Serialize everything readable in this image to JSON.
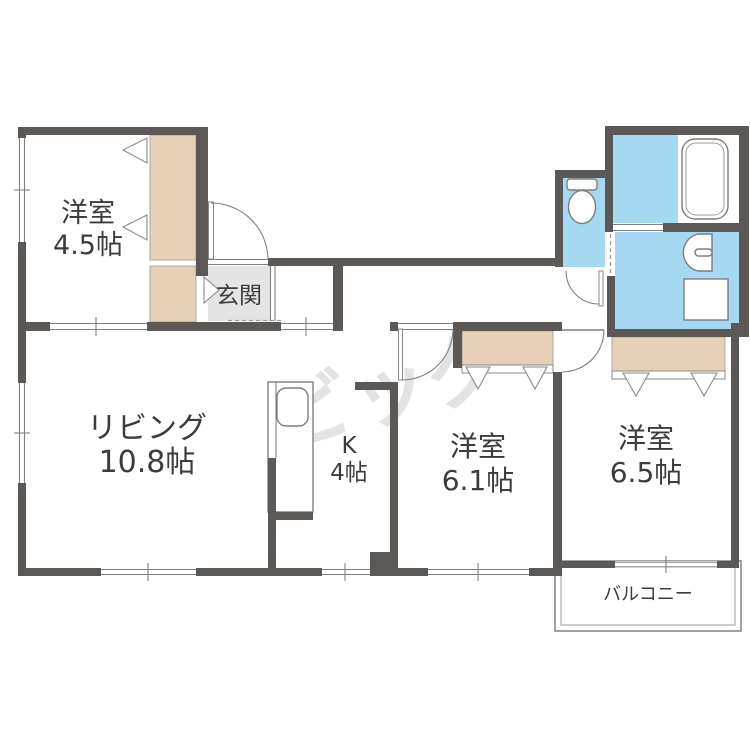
{
  "plan": {
    "title": "apartment-floor-plan",
    "rooms": [
      {
        "name": "洋室",
        "size": "4.5帖"
      },
      {
        "name": "リビング",
        "size": "10.8帖"
      },
      {
        "name": "K",
        "size": "4帖"
      },
      {
        "name": "洋室",
        "size": "6.1帖"
      },
      {
        "name": "洋室",
        "size": "6.5帖"
      }
    ],
    "entrance_label": "玄関",
    "balcony_label": "バルコニー",
    "watermark": "ビッグ",
    "fixtures": [
      "toilet",
      "bathtub",
      "washbasin",
      "washer-pan",
      "kitchen-counter-sink"
    ],
    "colors": {
      "wall": "#5b5856",
      "closet": "#e6d0b6",
      "water": "#a5d9f2",
      "genkan": "#e4e4e4",
      "line": "#808080",
      "text": "#3c3c3c",
      "watermark": "#e3e3e3"
    }
  }
}
